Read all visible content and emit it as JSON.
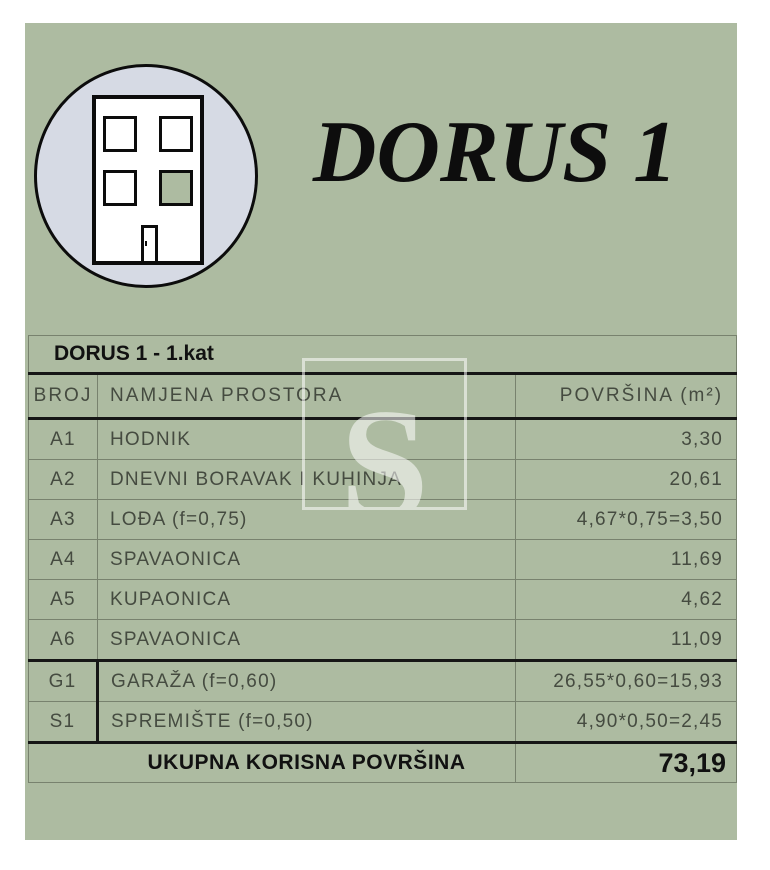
{
  "brand": {
    "title": "DORUS 1"
  },
  "logo": {
    "icon": "building-icon",
    "circle_fill": "#d6dae4",
    "green_window_fill": "#adbba1"
  },
  "watermark": {
    "letter": "S"
  },
  "table": {
    "title": "DORUS 1 - 1.kat",
    "headers": {
      "broj": "BROJ",
      "namjena": "NAMJENA PROSTORA",
      "povrsina": "POVRŠINA (m²)"
    },
    "rows": [
      {
        "broj": "A1",
        "namjena": "HODNIK",
        "povrsina": "3,30",
        "group": "a"
      },
      {
        "broj": "A2",
        "namjena": "DNEVNI BORAVAK I KUHINJA",
        "povrsina": "20,61",
        "group": "a"
      },
      {
        "broj": "A3",
        "namjena": "LOĐA (f=0,75)",
        "povrsina": "4,67*0,75=3,50",
        "group": "a"
      },
      {
        "broj": "A4",
        "namjena": "SPAVAONICA",
        "povrsina": "11,69",
        "group": "a"
      },
      {
        "broj": "A5",
        "namjena": "KUPAONICA",
        "povrsina": "4,62",
        "group": "a"
      },
      {
        "broj": "A6",
        "namjena": "SPAVAONICA",
        "povrsina": "11,09",
        "group": "a"
      },
      {
        "broj": "G1",
        "namjena": "GARAŽA (f=0,60)",
        "povrsina": "26,55*0,60=15,93",
        "group": "g"
      },
      {
        "broj": "S1",
        "namjena": "SPREMIŠTE (f=0,50)",
        "povrsina": "4,90*0,50=2,45",
        "group": "g"
      }
    ],
    "total": {
      "label": "UKUPNA KORISNA POVRŠINA",
      "value": "73,19"
    }
  },
  "colors": {
    "panel_green": "#adbba1",
    "thick_line": "#161616",
    "thin_line": "#78826e",
    "cad_text": "#454b40",
    "black_text": "#111111"
  }
}
